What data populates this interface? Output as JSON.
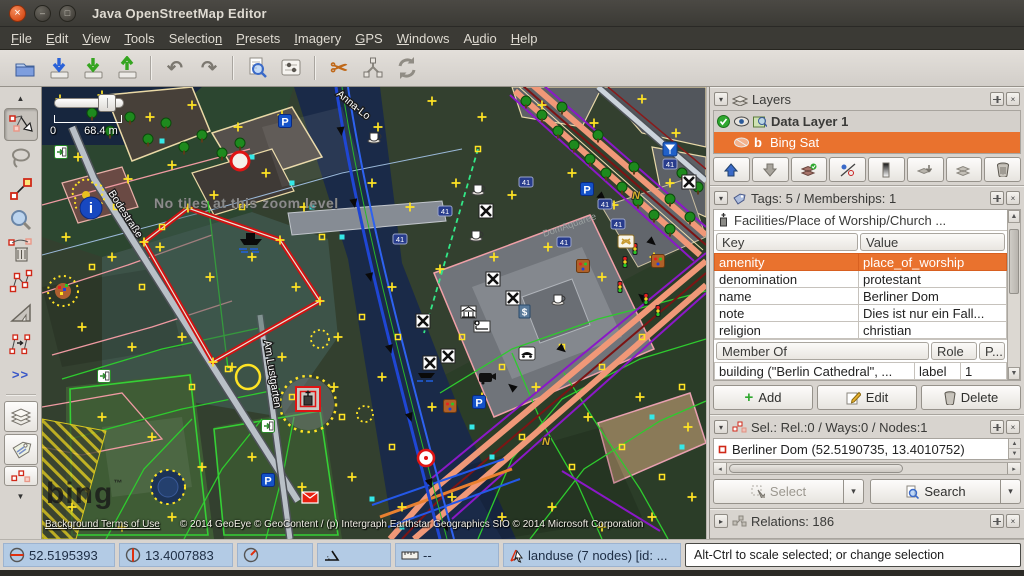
{
  "window": {
    "title": "Java OpenStreetMap Editor"
  },
  "menubar": {
    "items": [
      {
        "label": "File",
        "u": 0
      },
      {
        "label": "Edit",
        "u": 0
      },
      {
        "label": "View",
        "u": 0
      },
      {
        "label": "Tools",
        "u": 0
      },
      {
        "label": "Selection",
        "u": 8
      },
      {
        "label": "Presets",
        "u": 0
      },
      {
        "label": "Imagery",
        "u": 0
      },
      {
        "label": "GPS",
        "u": 0
      },
      {
        "label": "Windows",
        "u": 0
      },
      {
        "label": "Audio",
        "u": 1
      },
      {
        "label": "Help",
        "u": 0
      }
    ]
  },
  "icons": {
    "chevron_down": "▾",
    "chevron_right": "▸",
    "close": "×",
    "scroll_up": "▲",
    "scroll_down": "▼",
    "undo": "↶",
    "redo": "↷",
    "scissors": "✂",
    "check": "✓",
    "spin_up": "▲",
    "spin_down": "▼",
    "left": "◂",
    "right": "▸",
    "dropdown": "▾",
    "plus": "+"
  },
  "left_toolbar": {
    "more_label": ">>"
  },
  "map": {
    "no_tiles": "No tiles at this zoom level",
    "scale": {
      "zero": "0",
      "label": "68.4 m"
    },
    "attribution": {
      "logo": "bing",
      "tm": "™",
      "terms": "Background Terms of Use",
      "copyright": "© 2014 GeoEye © GeoContent / (p) Intergraph Earthstar Geographics SIO © 2014 Microsoft Corporation"
    },
    "streets": {
      "bodestrasse": "Bodestraße",
      "am_lustgarten": "Am Lustgarten",
      "anna": "Anna-Lo",
      "domaquaree": "DomAquaree"
    },
    "glyphs": {
      "parking": "P",
      "info": "i",
      "route_badge": "41",
      "atm": "$",
      "house_letter": "N"
    }
  },
  "panels": {
    "layers": {
      "title": "Layers",
      "rows": [
        {
          "label": "Data Layer 1"
        },
        {
          "label": "Bing Sat"
        }
      ]
    },
    "tags": {
      "title": "Tags: 5 / Memberships: 1",
      "preset": "Facilities/Place of Worship/Church ...",
      "columns": {
        "key": "Key",
        "value": "Value"
      },
      "rows": [
        {
          "key": "amenity",
          "value": "place_of_worship"
        },
        {
          "key": "denomination",
          "value": "protestant"
        },
        {
          "key": "name",
          "value": "Berliner Dom"
        },
        {
          "key": "note",
          "value": "Dies ist nur ein Fall..."
        },
        {
          "key": "religion",
          "value": "christian"
        }
      ],
      "membership": {
        "columns": {
          "member": "Member Of",
          "role": "Role",
          "position": "P..."
        },
        "rows": [
          {
            "member": "building (\"Berlin Cathedral\", ...",
            "role": "label",
            "position": "1"
          }
        ]
      },
      "buttons": {
        "add": "Add",
        "edit": "Edit",
        "delete": "Delete"
      }
    },
    "selection": {
      "title": "Sel.: Rel.:0 / Ways:0 / Nodes:1",
      "items": [
        {
          "label": "Berliner Dom (52.5190735, 13.4010752)"
        }
      ],
      "buttons": {
        "select": "Select",
        "search": "Search"
      }
    },
    "relations": {
      "title": "Relations: 186"
    }
  },
  "statusbar": {
    "lat": "52.5195393",
    "lon": "13.4007883",
    "heading": "",
    "angle": "",
    "distance": "--",
    "object": "landuse (7 nodes) [id: ...",
    "hint": "Alt-Ctrl to scale selected; or change selection"
  },
  "colors": {
    "accent_orange": "#e9722e",
    "status_blue": "#b3cbe5",
    "selection_red": "#cf1212",
    "titlebar": "#3b3a35"
  }
}
